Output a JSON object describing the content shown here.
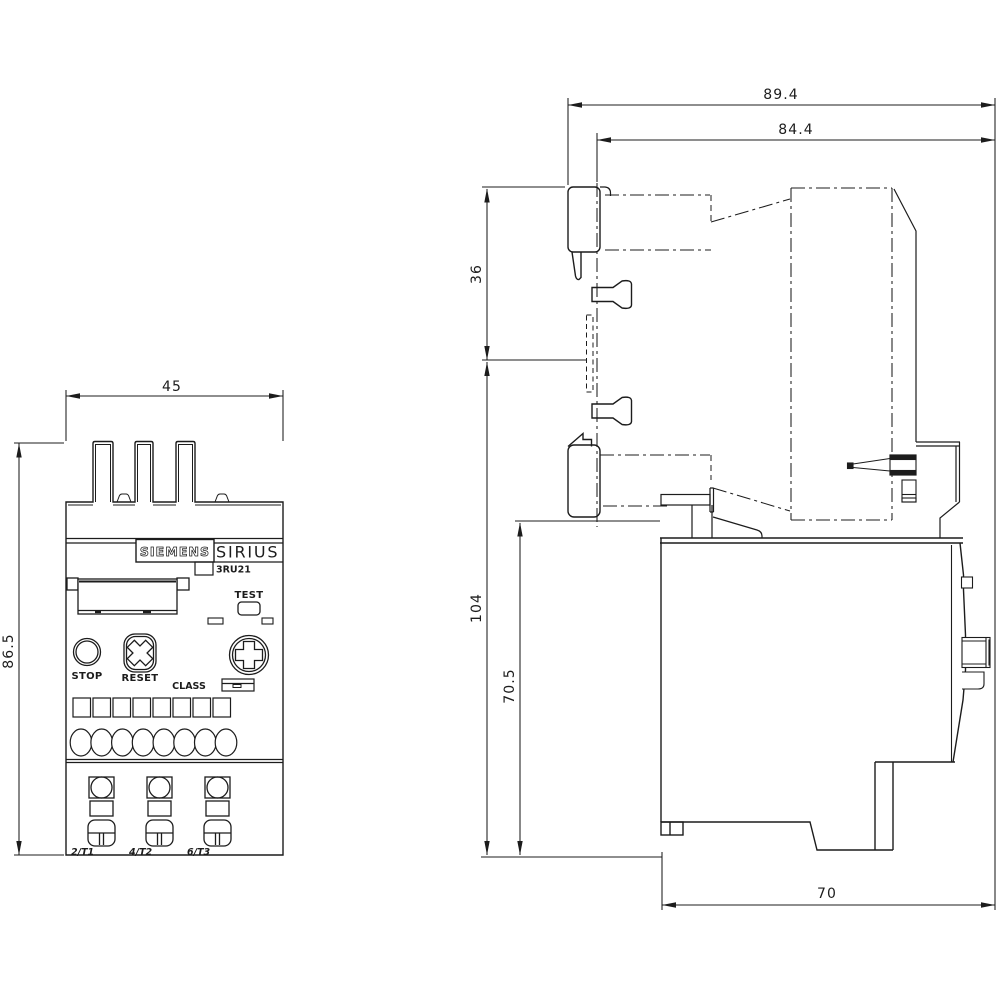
{
  "front_view": {
    "dim_width": "45",
    "dim_height": "86.5",
    "brand": "SIEMENS",
    "series": "SIRIUS",
    "model": "3RU21",
    "test_label": "TEST",
    "stop_label": "STOP",
    "reset_label": "RESET",
    "class_label": "CLASS",
    "terminal_labels": [
      "2/T1",
      "4/T2",
      "6/T3"
    ]
  },
  "side_view": {
    "dim_total_width": "89.4",
    "dim_body_width": "84.4",
    "dim_top_section": "36",
    "dim_total_height": "104",
    "dim_body_height": "70.5",
    "dim_depth": "70"
  },
  "colors": {
    "line": "#1c1c1c",
    "background": "#ffffff"
  }
}
